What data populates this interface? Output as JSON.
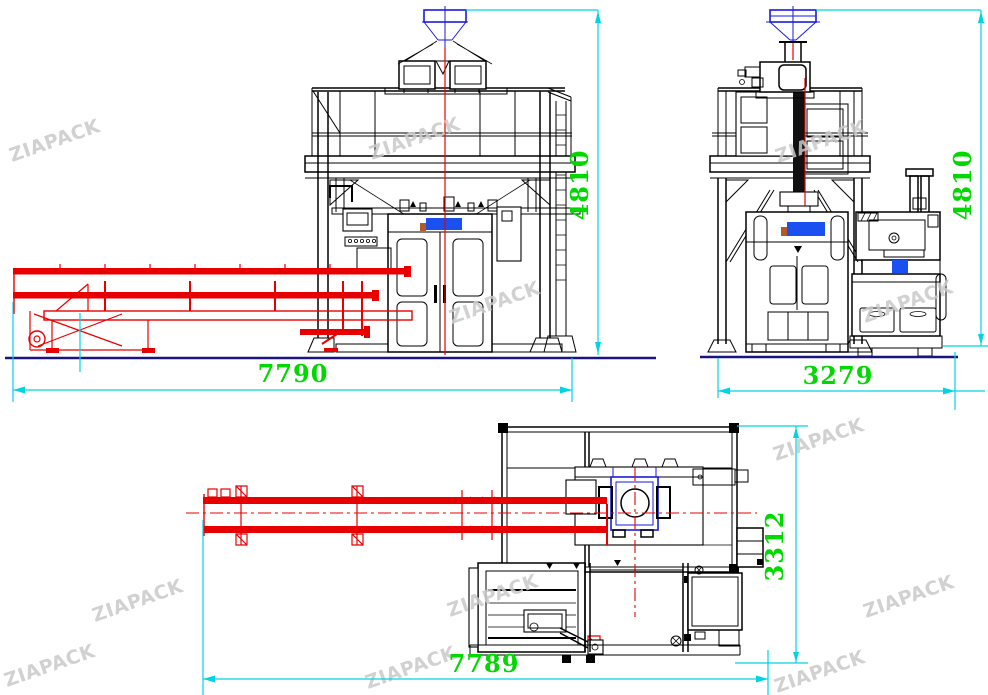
{
  "watermark": {
    "text": "ZIAPACK",
    "color": "#c9c9c9"
  },
  "brand": {
    "logo_blue": "#1a50f0",
    "logo_orange": "#b05a28"
  },
  "colors": {
    "dimension_line": "#00d4e4",
    "dimension_text": "#00d800",
    "conveyor_red": "#e80000",
    "funnel_blue": "#1a1ae0",
    "ground_line": "#1a1480",
    "machine_line": "#000000",
    "watermark_gray": "#c9c9c9"
  },
  "views": {
    "front": {
      "width_label": "7790",
      "height_label": "4810"
    },
    "side": {
      "width_label": "3279",
      "height_label": "4810"
    },
    "plan": {
      "width_label": "7789",
      "depth_label": "3312"
    }
  }
}
